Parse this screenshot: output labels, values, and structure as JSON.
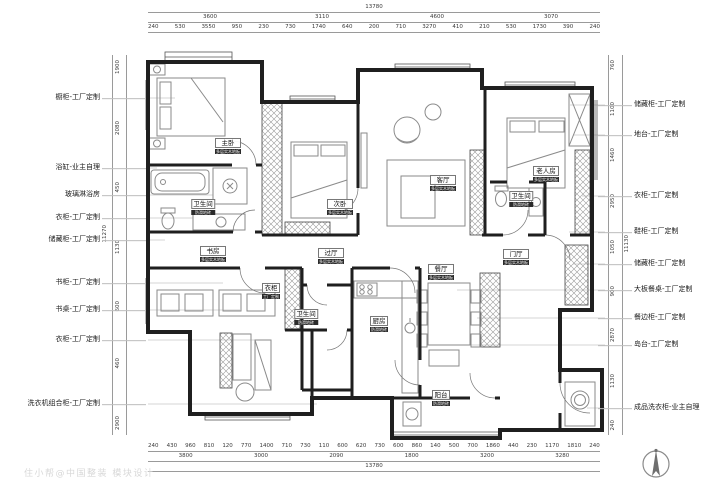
{
  "title": "户型定制平面布置图",
  "watermark": "住小帮@中国整装 模块设计",
  "colors": {
    "wall": "#1f1f1f",
    "furniture": "#8a8a8a",
    "hatch": "#9a9a9a",
    "dim_text": "#3a3a3a",
    "leader": "#bdbdbd"
  },
  "icons": {
    "compass": "north-arrow-icon"
  },
  "left_callouts": [
    "橱柜-工厂定制",
    "浴缸-业主自理",
    "玻璃淋浴房",
    "衣柜-工厂定制",
    "储藏柜-工厂定制",
    "书柜-工厂定制",
    "书桌-工厂定制",
    "衣柜-工厂定制",
    "洗衣机组合柜-工厂定制"
  ],
  "right_callouts": [
    "储藏柜-工厂定制",
    "地台-工厂定制",
    "衣柜-工厂定制",
    "鞋柜-工厂定制",
    "储藏柜-工厂定制",
    "大板餐桌-工厂定制",
    "餐边柜-工厂定制",
    "岛台-工厂定制",
    "成品洗衣柜-业主自理"
  ],
  "rooms": [
    {
      "name": "主卧",
      "sub": "多层实木地板"
    },
    {
      "name": "卫生间",
      "sub": "防滑地砖"
    },
    {
      "name": "次卧",
      "sub": "多层实木地板"
    },
    {
      "name": "客厅",
      "sub": "多层实木地板"
    },
    {
      "name": "老人房",
      "sub": "多层实木地板"
    },
    {
      "name": "卫生间",
      "sub": "防滑地砖"
    },
    {
      "name": "书房",
      "sub": "多层实木地板"
    },
    {
      "name": "过厅",
      "sub": "多层实木地板"
    },
    {
      "name": "衣柜",
      "sub": "工厂定制"
    },
    {
      "name": "卫生间",
      "sub": "防滑地砖"
    },
    {
      "name": "厨房",
      "sub": "防滑地砖"
    },
    {
      "name": "餐厅",
      "sub": "多层实木地板"
    },
    {
      "name": "门厅",
      "sub": "多层实木地板"
    },
    {
      "name": "阳台",
      "sub": "防滑地砖"
    }
  ],
  "dims": {
    "top": {
      "overall": "13780",
      "tier2": [
        "3600",
        "3110",
        "4600",
        "3070"
      ],
      "tier3": [
        "240",
        "530",
        "3550",
        "950",
        "230",
        "730",
        "1740",
        "640",
        "200",
        "710",
        "3270",
        "410",
        "210",
        "530",
        "1730",
        "390",
        "240"
      ]
    },
    "bottom": {
      "overall": "13780",
      "tier2": [
        "3800",
        "3000",
        "2090",
        "1800",
        "3200",
        "3280"
      ],
      "tier1": [
        "240",
        "430",
        "960",
        "810",
        "120",
        "770",
        "1400",
        "710",
        "730",
        "110",
        "600",
        "620",
        "730",
        "600",
        "860",
        "140",
        "500",
        "700",
        "1860",
        "440",
        "230",
        "1170",
        "1810",
        "240"
      ]
    },
    "left": {
      "overall": "11270",
      "inner": [
        "1900",
        "2080",
        "450",
        "1130",
        "600",
        "460",
        "2900"
      ]
    },
    "right": {
      "overall": "11130",
      "inner": [
        "760",
        "1100",
        "1460",
        "2950",
        "1050",
        "900",
        "2870",
        "1130",
        "240"
      ]
    }
  }
}
